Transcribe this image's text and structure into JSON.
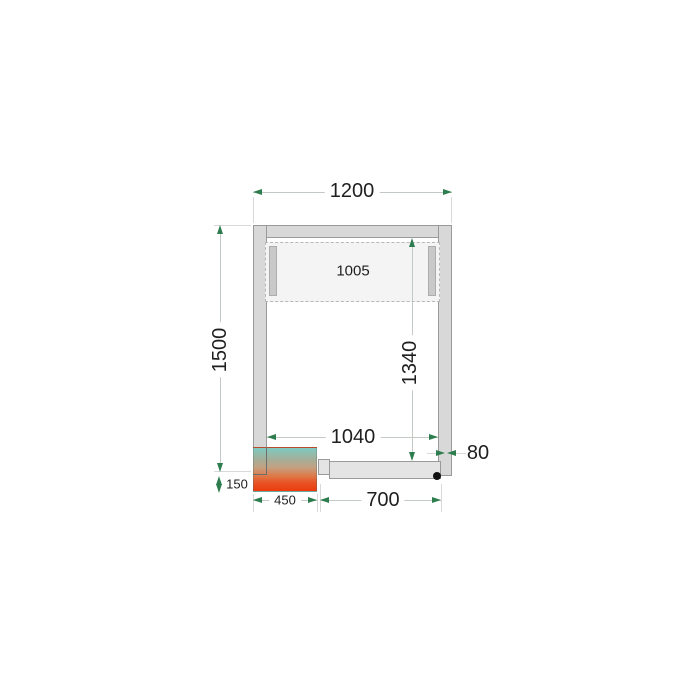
{
  "drawing": {
    "dims": {
      "outer_width": "1200",
      "outer_depth": "1500",
      "inner_width": "1040",
      "inner_depth": "1340",
      "wall_thickness": "80",
      "evaporator_length": "1005",
      "door_width": "700",
      "condenser_length": "450",
      "condenser_overhang": "150"
    },
    "colors": {
      "wall_fill": "#d8d8d8",
      "wall_stroke": "#9a9a9a",
      "dimension_line": "#c2cac3",
      "arrowhead": "#2e7d4f",
      "label_text": "#1f1f1f",
      "condenser_gradient_top": "#7fcac1",
      "condenser_gradient_bottom": "#ec3a0e",
      "door_fill": "#e4e4e4",
      "hinge_dot": "#111111"
    }
  }
}
